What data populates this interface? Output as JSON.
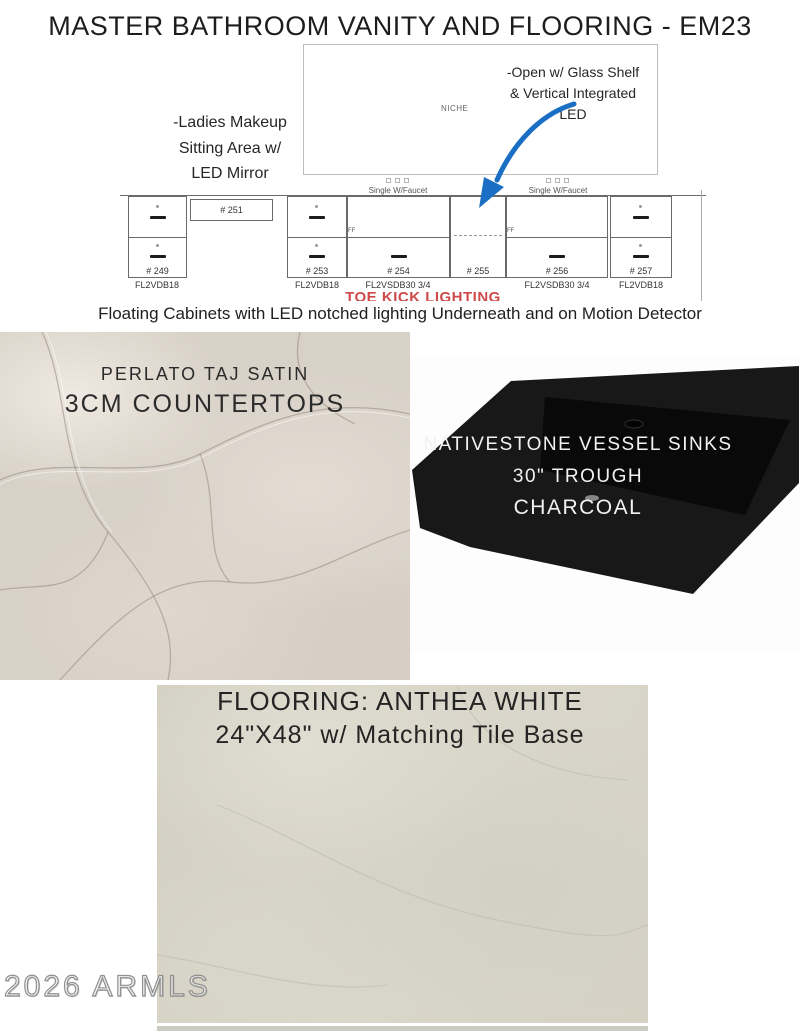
{
  "page": {
    "title": "MASTER BATHROOM VANITY AND FLOORING - EM23",
    "watermark": "2026 ARMLS"
  },
  "drawing": {
    "niche_label": "NICHE",
    "annotation_open_shelf": {
      "line1": "-Open w/ Glass Shelf",
      "line2": "& Vertical Integrated",
      "line3": "LED"
    },
    "annotation_makeup": {
      "line1": "-Ladies Makeup",
      "line2": "Sitting Area w/",
      "line3": "LED Mirror"
    },
    "single_faucet_label": "Single W/Faucet",
    "ff_label": "FF",
    "toe_kick_label": "TOE KICK LIGHTING",
    "cabinets": [
      {
        "number": "# 249",
        "model": "FL2VDB18"
      },
      {
        "number": "# 251",
        "model": ""
      },
      {
        "number": "# 253",
        "model": "FL2VDB18"
      },
      {
        "number": "# 254",
        "model": "FL2VSDB30 3/4"
      },
      {
        "number": "# 255",
        "model": ""
      },
      {
        "number": "# 256",
        "model": "FL2VSDB30 3/4"
      },
      {
        "number": "# 257",
        "model": "FL2VDB18"
      }
    ]
  },
  "caption": {
    "text": "Floating Cabinets with LED notched lighting Underneath and on Motion Detector"
  },
  "countertop": {
    "title": "PERLATO TAJ SATIN",
    "subtitle": "3CM COUNTERTOPS"
  },
  "sink": {
    "line1": "NATIVESTONE VESSEL SINKS",
    "line2": "30\" TROUGH",
    "line3": "CHARCOAL"
  },
  "flooring": {
    "line1": "FLOORING: ANTHEA WHITE",
    "line2": "24\"X48\" w/ Matching Tile Base"
  },
  "colors": {
    "arrow_blue": "#1a6fc4",
    "toe_kick_red": "#cf4a4a",
    "sink_black": "#161616",
    "marble_base": "#d8d1c8",
    "tile_base": "#d6d3c5"
  }
}
